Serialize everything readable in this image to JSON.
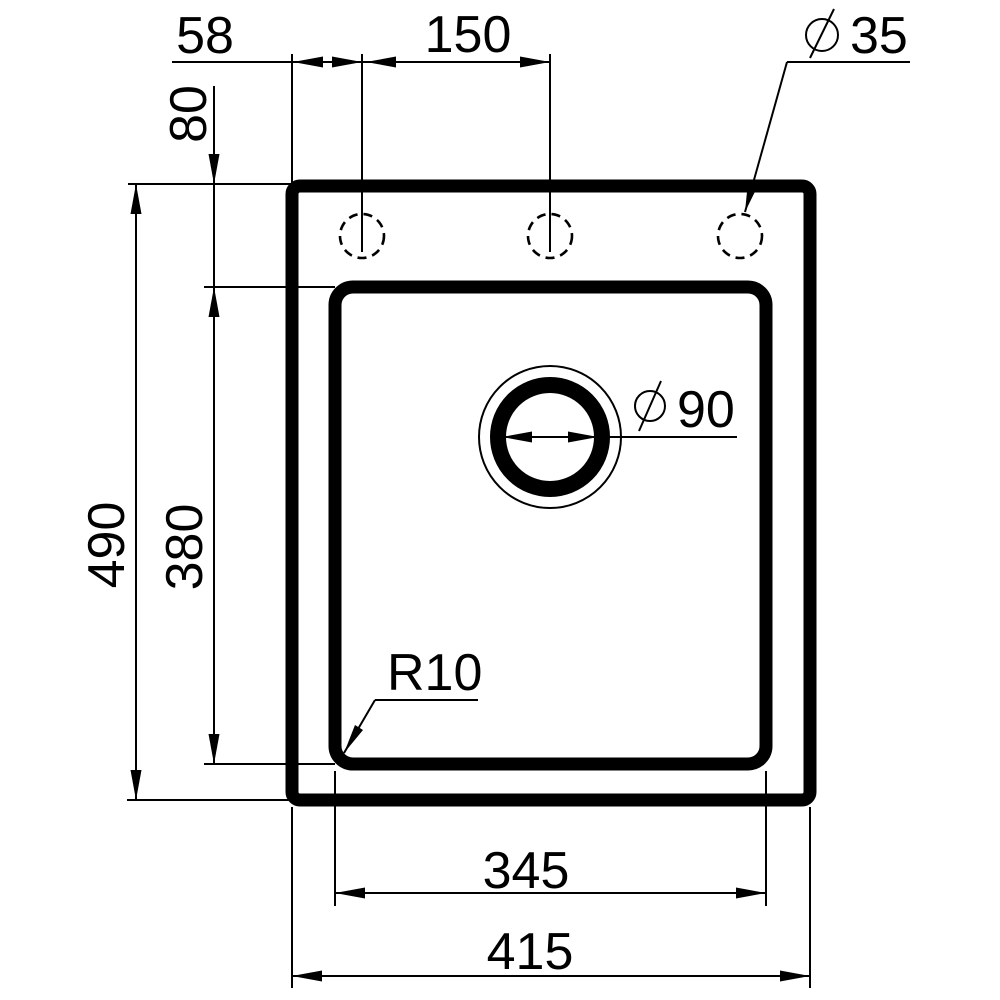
{
  "drawing": {
    "subject": "sink-top-view-dimension-drawing",
    "colors": {
      "line": "#000000",
      "background": "#ffffff"
    },
    "symbols": {
      "diameter": "⌀"
    },
    "dimensions": {
      "hole_offset": {
        "value": "58"
      },
      "hole_spacing": {
        "value": "150"
      },
      "hole_diameter": {
        "symbol": "⌀",
        "value": "35"
      },
      "rim_to_bowl_top": {
        "value": "80"
      },
      "outer_height": {
        "value": "490"
      },
      "bowl_height": {
        "value": "380"
      },
      "bowl_corner_radius": {
        "value": "R10"
      },
      "drain_diameter": {
        "symbol": "⌀",
        "value": "90"
      },
      "bowl_width": {
        "value": "345"
      },
      "outer_width": {
        "value": "415"
      }
    }
  }
}
